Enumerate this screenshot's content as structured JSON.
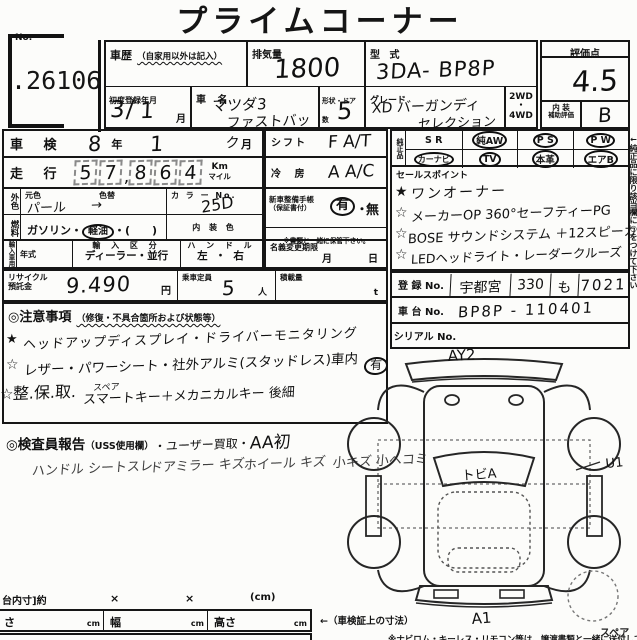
{
  "page": {
    "title": "プライムコーナー",
    "no_label": "No.",
    "no_value": ".26106"
  },
  "top": {
    "shareki_label": "車歴",
    "shareki_sub": "（自家用以外は記入）",
    "haikiryo_label": "排気量",
    "haikiryo_value": "1800",
    "katashiki_label": "型 式",
    "katashiki_value": "3DA- BP8P",
    "shodo_label": "初度登録年月",
    "shodo_year": "3",
    "shodo_slash": "/",
    "shodo_month": "1",
    "month_glyph": "月",
    "shamei_label": "車 名",
    "shamei_value1": "マツダ3",
    "shamei_value2": "ファストバック",
    "doors_label": "形状・ドア数",
    "doors_value": "5",
    "grade_label": "グレード",
    "grade_value1": "XD バーガンディ",
    "grade_value2": "セレクション",
    "drive_2wd": "2WD",
    "drive_dot": "・",
    "drive_4wd": "4WD",
    "rating_label": "評価点",
    "rating_value": "4.5",
    "interior_label1": "内 装",
    "interior_label2": "補助評価",
    "interior_value": "B"
  },
  "specs": {
    "shaken_label": "車 検",
    "shaken_year": "8",
    "year_glyph": "年",
    "shaken_month": "1",
    "month_glyph": "月",
    "soko_label": "走 行",
    "soko_digits": [
      "5",
      "7",
      "8",
      "6",
      "4"
    ],
    "soko_comma": ",",
    "unit_km": "Km",
    "unit_mile": "マイル",
    "gaishoku_vert": "外色",
    "moto_label": "元色",
    "irogae_label": "色替",
    "color_value": "パール",
    "color_arrow": "→",
    "colorno_label": "カ ラ ー No.",
    "colorno_value": "25D",
    "nenryo_vert": "燃料",
    "fuel_gasoline": "ガソリン・",
    "fuel_diesel": "軽油",
    "fuel_paren": "・(　　)",
    "naiso_label": "内 装 色",
    "import_vert": "輸入車用",
    "nenshiki_label": "年式",
    "import_label": "輸 入 区 分",
    "import_value": "ディーラー・並行",
    "handle_label": "ハ ン ド ル",
    "handle_value": "左 ・ 右",
    "recycle_label1": "リサイクル",
    "recycle_label2": "預託金",
    "recycle_value": "9.490",
    "yen": "円",
    "teiin_label": "乗車定員",
    "teiin_value": "5",
    "nin": "人",
    "sekisai_label": "積載量",
    "ton": "t",
    "shift_label": "シフト",
    "shift_value": "F A/T",
    "aircon_label": "冷 房",
    "aircon_value": "A A/C",
    "techo_label1": "新車整備手帳",
    "techo_label2": "（保証書付）",
    "ari": "有",
    "dot": "・",
    "nashi": "無",
    "techo_note": "※書類と一緒に保管下さい。",
    "meigi_label": "名義変更期限",
    "meigi_month": "月",
    "meigi_day": "日"
  },
  "junsei": {
    "label": "純正品",
    "row1": [
      {
        "t": "S R",
        "c": false
      },
      {
        "t": "純AW",
        "c": true
      },
      {
        "t": "P S",
        "c": true
      },
      {
        "t": "P W",
        "c": true
      }
    ],
    "row2": [
      {
        "t": "カーナビ",
        "c": true
      },
      {
        "t": "TV",
        "c": true
      },
      {
        "t": "本革",
        "c": true
      },
      {
        "t": "エアB",
        "c": true
      }
    ]
  },
  "sales": {
    "label": "セールスポイント",
    "items": [
      {
        "star": "★",
        "text": "ワンオーナー"
      },
      {
        "star": "☆",
        "text": "メーカーOP 360°セーフティーPG"
      },
      {
        "star": "☆",
        "text": "BOSE サウンドシステム ＋12スピーカー"
      },
      {
        "star": "☆",
        "text": "LEDヘッドライト・レーダークルーズ"
      }
    ]
  },
  "registration": {
    "toroku_label": "登 録 No.",
    "area": "宇都宮",
    "class_no": "330",
    "kana": "も",
    "num": "7021",
    "shadai_label": "車 台 No.",
    "shadai_value": "BP8P - 110401",
    "serial_label": "シリアル No."
  },
  "notes": {
    "header": "◎注意事項",
    "header_sub": "（修復・不具合箇所および状態等）",
    "star1": "★",
    "line1": "ヘッドアップディスプレイ・ドライバーモニタリング",
    "star2": "☆",
    "line2": "レザー・パワーシート・社外アルミ(スタッドレス)車内",
    "line2_circled": "有",
    "star3": "☆",
    "line3_pre": "整.保.取.",
    "line3_top": "スペア",
    "line3_main": "スマートキー＋メカニカルキー 後細"
  },
  "inspector": {
    "header": "◎検査員報告",
    "header_sub": "（USS使用欄）",
    "hand_note": "・ユーザー買取・",
    "hand_note2": "AA初",
    "hand_lines": [
      "ハンドル シートスレ",
      "ドアミラー キズ",
      "ホイール キズ",
      "小キズ 小ヘコミ"
    ]
  },
  "bottom": {
    "nidai_label": "台内寸]約",
    "x1": "×",
    "x2": "×",
    "cm_paren": "(cm)",
    "len_label": "さ",
    "width_label": "幅",
    "height_label": "高さ",
    "cm": "cm",
    "shaken_sunpo": "←（車検証上の寸法）",
    "footer_left": "整 備 手 帳 ・ ス ペ ア キ ー",
    "footer_right": "※ナビロム・キーレス・リモコン等は、譲渡書類と一緒に送付して下さい"
  },
  "side_note": "←純正品に限り該当欄に○をつけて下さい",
  "diagram": {
    "front": "AY2",
    "windshield": "トビA",
    "right_side": "U1",
    "rear": "A1",
    "spare": "スペア"
  }
}
